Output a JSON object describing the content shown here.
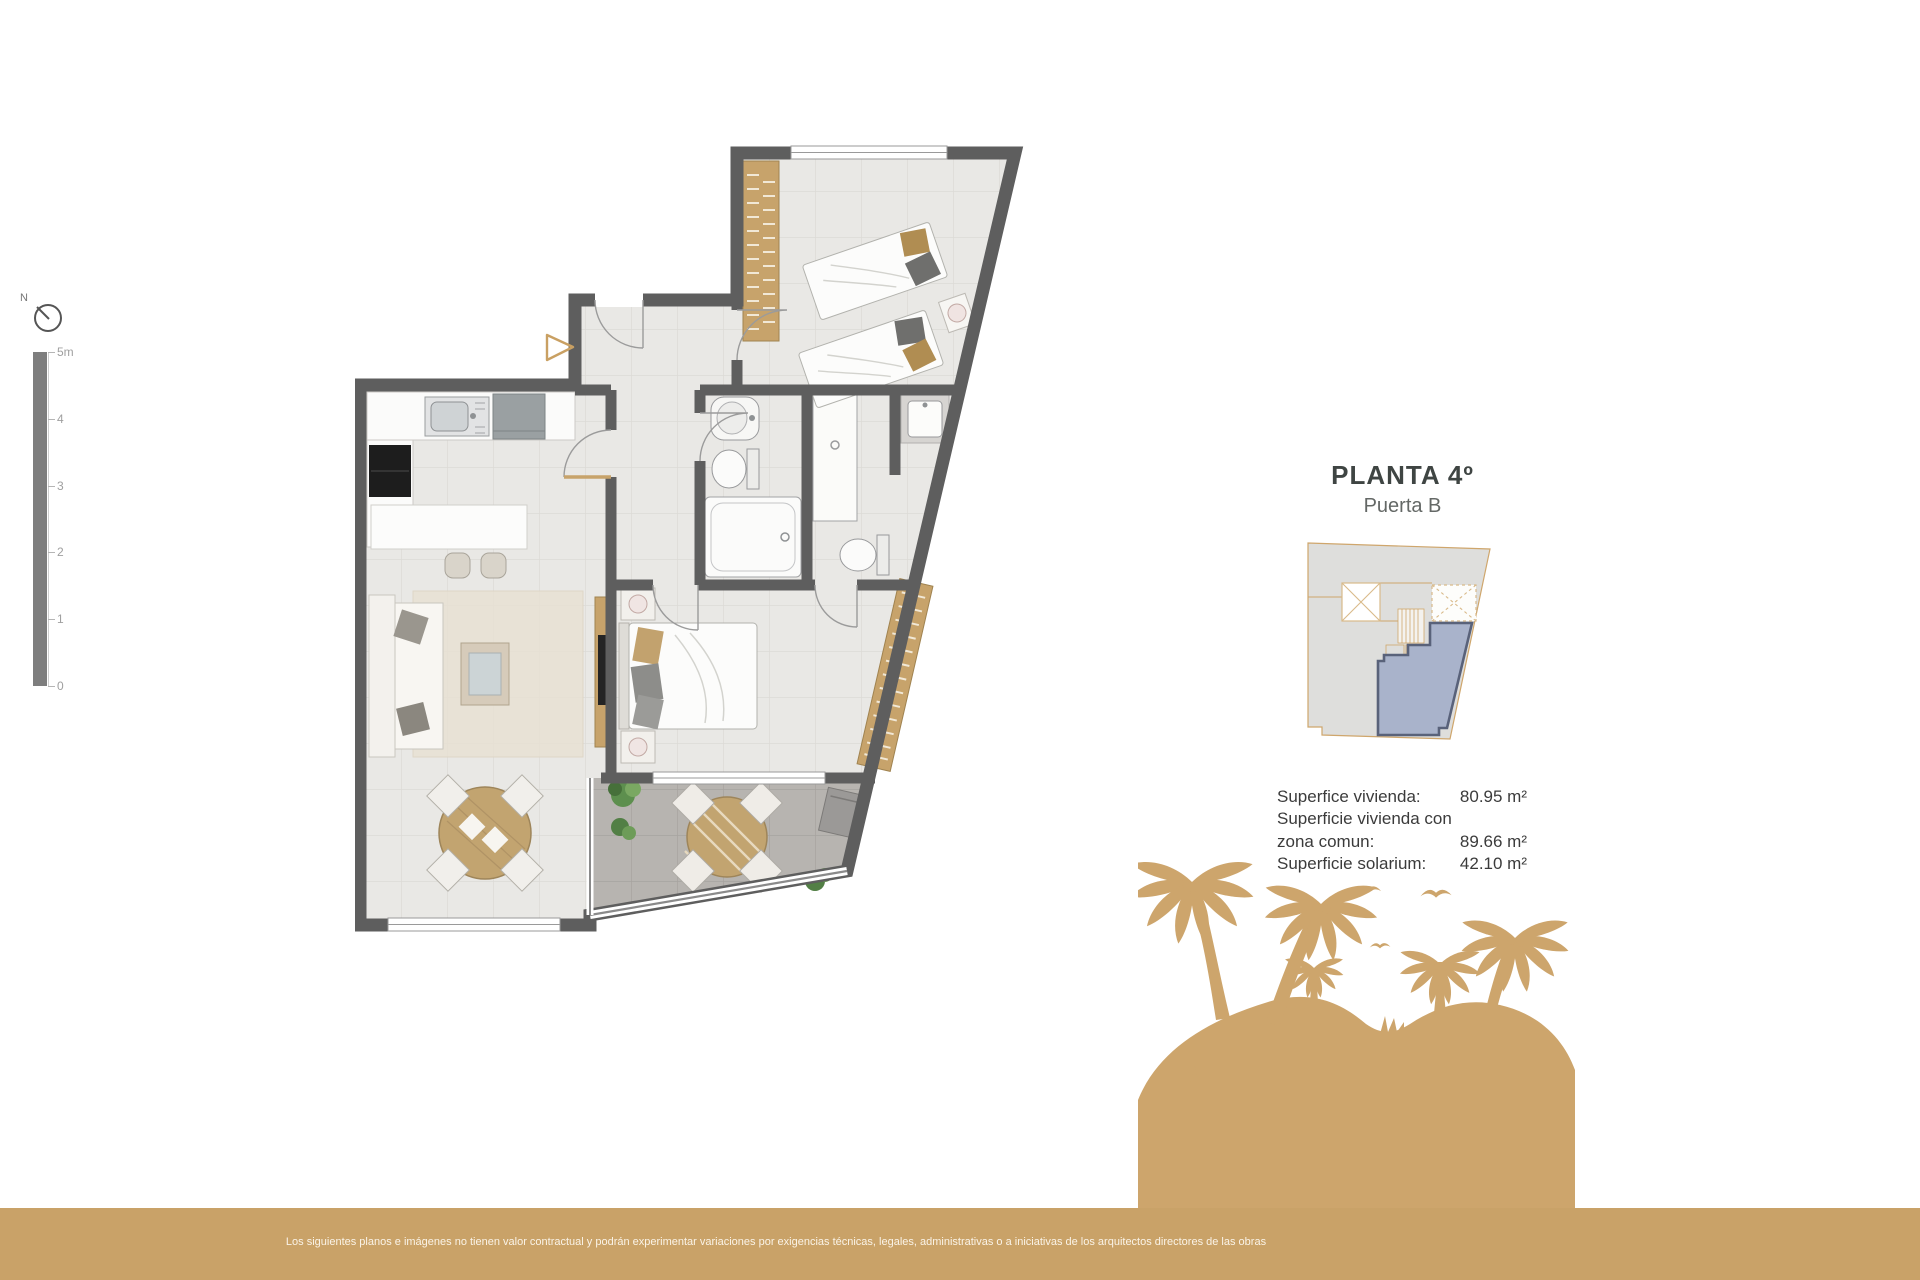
{
  "compass": {
    "label": "N"
  },
  "scale_bar": {
    "ticks": [
      "5m",
      "4",
      "3",
      "2",
      "1",
      "0"
    ]
  },
  "title_block": {
    "title": "PLANTA 4º",
    "subtitle": "Puerta B"
  },
  "surfaces": {
    "rows": [
      {
        "label": "Superfice vivienda:",
        "value": "80.95 m²"
      },
      {
        "label": "Superficie vivienda con zona comun:",
        "value": "89.66 m²"
      },
      {
        "label": "Superficie solarium:",
        "value": "42.10 m²"
      }
    ]
  },
  "footer": {
    "disclaimer": "Los siguientes planos e imágenes no tienen valor contractual y podrán experimentar variaciones por exigencias técnicas, legales, administrativas o a iniciativas de los arquitectos directores de las obras"
  },
  "icons": {
    "compass": "north-compass-icon",
    "entrance": "entrance-arrow-icon"
  },
  "colors": {
    "accent_tan": "#c9a268",
    "wood_tan": "#c7a36b",
    "wall_gray": "#5e5e5e",
    "floor_light": "#e9e8e5",
    "terrace_gray": "#b7b4b0",
    "unit_highlight_fill": "#a9b3cb",
    "unit_highlight_border": "#59627a",
    "keyplan_building": "#dededc",
    "title_text": "#3f4543"
  }
}
